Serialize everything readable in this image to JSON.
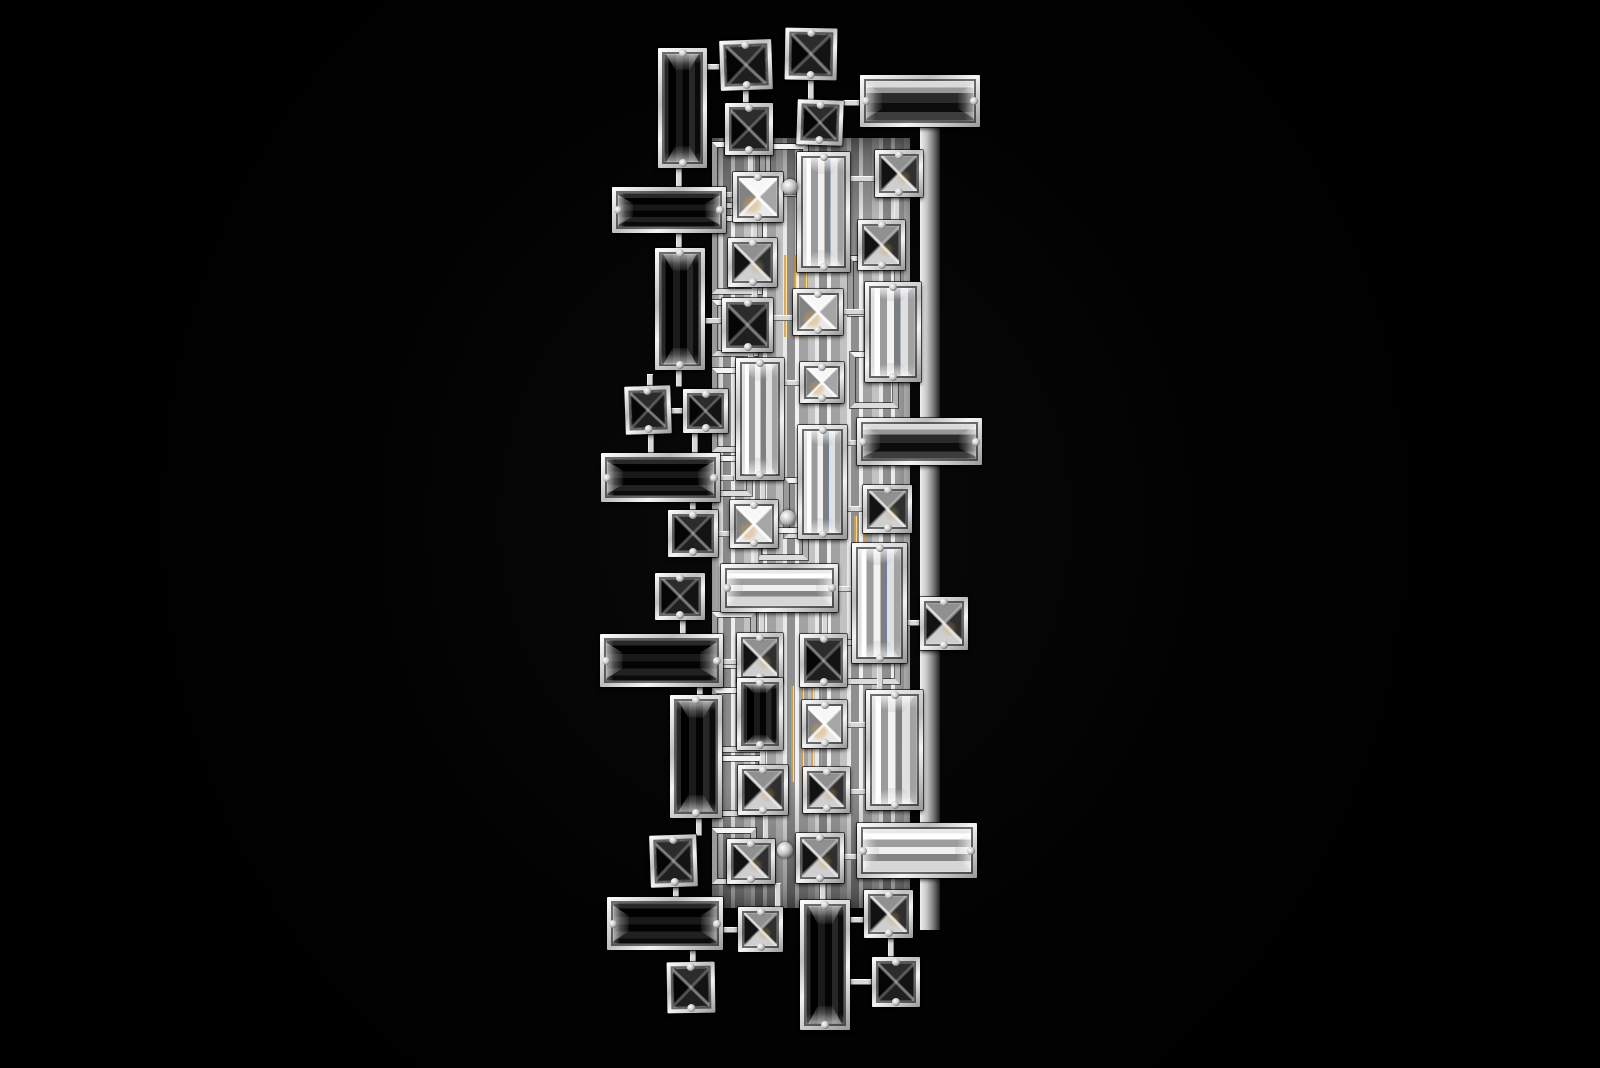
{
  "scene": {
    "subject": "Product photograph of a vertical crystal wall sconce: chrome lattice frames holding square pyramid-cut crystals and long baguette crystals; black crystals on the left, clear and smoke crystals over a lit chrome center column; pure black background",
    "background_color": "#000000",
    "chrome_color": "#e8e8e8",
    "black_crystal_color": "#0a0a0a",
    "clear_crystal_color": "#dcdcdc",
    "smoke_crystal_color": "#6e6e6e",
    "filament_glow_color": "#d9a752",
    "refraction_blue": "#56749e"
  },
  "fixture": {
    "bounds": {
      "x": 600,
      "y": 28,
      "w": 382,
      "h": 1002
    },
    "backplate": {
      "x": 920,
      "y": 115,
      "w": 20,
      "h": 815
    },
    "center_panel": {
      "x": 712,
      "y": 138,
      "w": 198,
      "h": 770
    },
    "frames": [
      {
        "x": 712,
        "y": 142,
        "w": 58,
        "h": 66
      },
      {
        "x": 760,
        "y": 144,
        "w": 48,
        "h": 52
      },
      {
        "x": 712,
        "y": 216,
        "w": 50,
        "h": 78
      },
      {
        "x": 848,
        "y": 256,
        "w": 52,
        "h": 60
      },
      {
        "x": 712,
        "y": 300,
        "w": 46,
        "h": 56
      },
      {
        "x": 850,
        "y": 352,
        "w": 48,
        "h": 56
      },
      {
        "x": 712,
        "y": 368,
        "w": 44,
        "h": 84
      },
      {
        "x": 712,
        "y": 456,
        "w": 40,
        "h": 40
      },
      {
        "x": 784,
        "y": 478,
        "w": 56,
        "h": 60
      },
      {
        "x": 756,
        "y": 528,
        "w": 52,
        "h": 32
      },
      {
        "x": 712,
        "y": 612,
        "w": 44,
        "h": 56
      },
      {
        "x": 840,
        "y": 640,
        "w": 60,
        "h": 44
      },
      {
        "x": 712,
        "y": 688,
        "w": 48,
        "h": 64
      },
      {
        "x": 712,
        "y": 756,
        "w": 52,
        "h": 60
      },
      {
        "x": 712,
        "y": 828,
        "w": 44,
        "h": 56
      }
    ],
    "glow_streaks": [
      {
        "x": 781,
        "y": 255,
        "w": 28,
        "h": 82
      },
      {
        "x": 788,
        "y": 686,
        "w": 34,
        "h": 96
      },
      {
        "x": 851,
        "y": 516,
        "w": 14,
        "h": 50
      }
    ],
    "connectors": [
      [
        705,
        64,
        15,
        6
      ],
      [
        743,
        90,
        6,
        14
      ],
      [
        808,
        80,
        6,
        21
      ],
      [
        843,
        100,
        17,
        6
      ],
      [
        676,
        168,
        6,
        20
      ],
      [
        748,
        155,
        6,
        18
      ],
      [
        726,
        192,
        8,
        6
      ],
      [
        778,
        189,
        20,
        6
      ],
      [
        850,
        176,
        25,
        6
      ],
      [
        894,
        197,
        6,
        24
      ],
      [
        752,
        218,
        6,
        21
      ],
      [
        676,
        233,
        6,
        16
      ],
      [
        752,
        287,
        6,
        12
      ],
      [
        773,
        315,
        20,
        6
      ],
      [
        843,
        309,
        22,
        6
      ],
      [
        705,
        318,
        17,
        6
      ],
      [
        748,
        352,
        6,
        7
      ],
      [
        676,
        370,
        6,
        17
      ],
      [
        647,
        374,
        6,
        13
      ],
      [
        670,
        408,
        14,
        6
      ],
      [
        648,
        434,
        6,
        20
      ],
      [
        692,
        433,
        6,
        21
      ],
      [
        720,
        475,
        14,
        6
      ],
      [
        760,
        480,
        6,
        21
      ],
      [
        784,
        380,
        17,
        6
      ],
      [
        847,
        440,
        11,
        6
      ],
      [
        847,
        506,
        17,
        6
      ],
      [
        690,
        502,
        6,
        9
      ],
      [
        716,
        531,
        15,
        6
      ],
      [
        753,
        548,
        6,
        17
      ],
      [
        680,
        620,
        6,
        15
      ],
      [
        759,
        612,
        6,
        22
      ],
      [
        822,
        612,
        6,
        23
      ],
      [
        836,
        586,
        17,
        6
      ],
      [
        877,
        663,
        6,
        28
      ],
      [
        905,
        620,
        16,
        6
      ],
      [
        697,
        687,
        6,
        9
      ],
      [
        723,
        659,
        14,
        6
      ],
      [
        760,
        747,
        6,
        19
      ],
      [
        847,
        722,
        20,
        6
      ],
      [
        850,
        789,
        17,
        6
      ],
      [
        696,
        818,
        6,
        18
      ],
      [
        763,
        814,
        6,
        26
      ],
      [
        673,
        887,
        6,
        11
      ],
      [
        775,
        883,
        6,
        25
      ],
      [
        820,
        883,
        6,
        18
      ],
      [
        844,
        854,
        14,
        6
      ],
      [
        690,
        949,
        6,
        14
      ],
      [
        723,
        927,
        16,
        6
      ],
      [
        850,
        917,
        15,
        6
      ],
      [
        888,
        938,
        6,
        20
      ],
      [
        850,
        979,
        23,
        6
      ]
    ],
    "crystals": [
      {
        "x": 658,
        "y": 48,
        "w": 49,
        "h": 120,
        "shape": "baguette-vertical",
        "tone": "black"
      },
      {
        "x": 720,
        "y": 40,
        "w": 52,
        "h": 50,
        "shape": "square",
        "tone": "black",
        "rot": -2
      },
      {
        "x": 785,
        "y": 28,
        "w": 52,
        "h": 52,
        "shape": "square",
        "tone": "black",
        "rot": 1
      },
      {
        "x": 725,
        "y": 103,
        "w": 48,
        "h": 52,
        "shape": "square",
        "tone": "black"
      },
      {
        "x": 797,
        "y": 100,
        "w": 46,
        "h": 45,
        "shape": "square",
        "tone": "black",
        "rot": 2
      },
      {
        "x": 860,
        "y": 75,
        "w": 120,
        "h": 52,
        "shape": "baguette-horizontal",
        "tone": "smoke"
      },
      {
        "x": 612,
        "y": 187,
        "w": 114,
        "h": 46,
        "shape": "baguette-horizontal",
        "tone": "black"
      },
      {
        "x": 733,
        "y": 172,
        "w": 50,
        "h": 50,
        "shape": "square",
        "tone": "clear"
      },
      {
        "x": 797,
        "y": 152,
        "w": 53,
        "h": 120,
        "shape": "baguette-vertical",
        "tone": "clear"
      },
      {
        "x": 875,
        "y": 150,
        "w": 48,
        "h": 47,
        "shape": "square",
        "tone": "smoke"
      },
      {
        "x": 858,
        "y": 220,
        "w": 47,
        "h": 50,
        "shape": "square",
        "tone": "smoke"
      },
      {
        "x": 728,
        "y": 238,
        "w": 49,
        "h": 49,
        "shape": "square",
        "tone": "smoke"
      },
      {
        "x": 655,
        "y": 248,
        "w": 50,
        "h": 122,
        "shape": "baguette-vertical",
        "tone": "black"
      },
      {
        "x": 722,
        "y": 298,
        "w": 51,
        "h": 54,
        "shape": "square",
        "tone": "black"
      },
      {
        "x": 793,
        "y": 289,
        "w": 50,
        "h": 46,
        "shape": "square",
        "tone": "clear"
      },
      {
        "x": 865,
        "y": 282,
        "w": 56,
        "h": 100,
        "shape": "baguette-vertical",
        "tone": "clear"
      },
      {
        "x": 800,
        "y": 362,
        "w": 44,
        "h": 41,
        "shape": "square",
        "tone": "clear"
      },
      {
        "x": 736,
        "y": 358,
        "w": 48,
        "h": 122,
        "shape": "baguette-vertical",
        "tone": "clear"
      },
      {
        "x": 625,
        "y": 386,
        "w": 46,
        "h": 48,
        "shape": "square",
        "tone": "black",
        "rot": -2
      },
      {
        "x": 683,
        "y": 389,
        "w": 45,
        "h": 44,
        "shape": "square",
        "tone": "black"
      },
      {
        "x": 857,
        "y": 418,
        "w": 125,
        "h": 47,
        "shape": "baguette-horizontal",
        "tone": "smoke"
      },
      {
        "x": 601,
        "y": 453,
        "w": 119,
        "h": 49,
        "shape": "baguette-horizontal",
        "tone": "black"
      },
      {
        "x": 798,
        "y": 425,
        "w": 49,
        "h": 114,
        "shape": "baguette-vertical",
        "tone": "clear"
      },
      {
        "x": 863,
        "y": 485,
        "w": 49,
        "h": 48,
        "shape": "square",
        "tone": "smoke"
      },
      {
        "x": 730,
        "y": 500,
        "w": 48,
        "h": 48,
        "shape": "square",
        "tone": "clear"
      },
      {
        "x": 668,
        "y": 510,
        "w": 50,
        "h": 47,
        "shape": "square",
        "tone": "black"
      },
      {
        "x": 721,
        "y": 564,
        "w": 117,
        "h": 48,
        "shape": "baguette-horizontal",
        "tone": "clear"
      },
      {
        "x": 852,
        "y": 543,
        "w": 55,
        "h": 120,
        "shape": "baguette-vertical",
        "tone": "clear"
      },
      {
        "x": 655,
        "y": 573,
        "w": 50,
        "h": 47,
        "shape": "square",
        "tone": "black"
      },
      {
        "x": 920,
        "y": 597,
        "w": 48,
        "h": 53,
        "shape": "square",
        "tone": "smoke"
      },
      {
        "x": 600,
        "y": 634,
        "w": 123,
        "h": 53,
        "shape": "baguette-horizontal",
        "tone": "black"
      },
      {
        "x": 737,
        "y": 633,
        "w": 46,
        "h": 49,
        "shape": "square",
        "tone": "smoke"
      },
      {
        "x": 800,
        "y": 634,
        "w": 47,
        "h": 53,
        "shape": "square",
        "tone": "black"
      },
      {
        "x": 670,
        "y": 695,
        "w": 52,
        "h": 123,
        "shape": "baguette-vertical",
        "tone": "black"
      },
      {
        "x": 737,
        "y": 678,
        "w": 46,
        "h": 72,
        "shape": "baguette-vertical",
        "tone": "black"
      },
      {
        "x": 802,
        "y": 700,
        "w": 45,
        "h": 48,
        "shape": "square",
        "tone": "clear"
      },
      {
        "x": 866,
        "y": 690,
        "w": 57,
        "h": 120,
        "shape": "baguette-vertical",
        "tone": "clear"
      },
      {
        "x": 738,
        "y": 765,
        "w": 50,
        "h": 50,
        "shape": "square",
        "tone": "smoke"
      },
      {
        "x": 803,
        "y": 767,
        "w": 47,
        "h": 46,
        "shape": "square",
        "tone": "smoke"
      },
      {
        "x": 650,
        "y": 835,
        "w": 47,
        "h": 52,
        "shape": "square",
        "tone": "black",
        "rot": -2
      },
      {
        "x": 727,
        "y": 839,
        "w": 48,
        "h": 45,
        "shape": "square",
        "tone": "smoke"
      },
      {
        "x": 796,
        "y": 833,
        "w": 48,
        "h": 50,
        "shape": "square",
        "tone": "smoke"
      },
      {
        "x": 857,
        "y": 823,
        "w": 120,
        "h": 55,
        "shape": "baguette-horizontal",
        "tone": "clear"
      },
      {
        "x": 607,
        "y": 897,
        "w": 116,
        "h": 53,
        "shape": "baguette-horizontal",
        "tone": "black"
      },
      {
        "x": 738,
        "y": 907,
        "w": 45,
        "h": 45,
        "shape": "square",
        "tone": "smoke"
      },
      {
        "x": 864,
        "y": 890,
        "w": 49,
        "h": 48,
        "shape": "square",
        "tone": "smoke"
      },
      {
        "x": 667,
        "y": 962,
        "w": 48,
        "h": 51,
        "shape": "square",
        "tone": "black",
        "rot": -1
      },
      {
        "x": 800,
        "y": 900,
        "w": 50,
        "h": 130,
        "shape": "baguette-vertical",
        "tone": "black"
      },
      {
        "x": 872,
        "y": 957,
        "w": 48,
        "h": 50,
        "shape": "square",
        "tone": "black"
      }
    ],
    "bolts": [
      {
        "x": 790,
        "y": 187
      },
      {
        "x": 788,
        "y": 518
      },
      {
        "x": 785,
        "y": 850
      }
    ]
  }
}
